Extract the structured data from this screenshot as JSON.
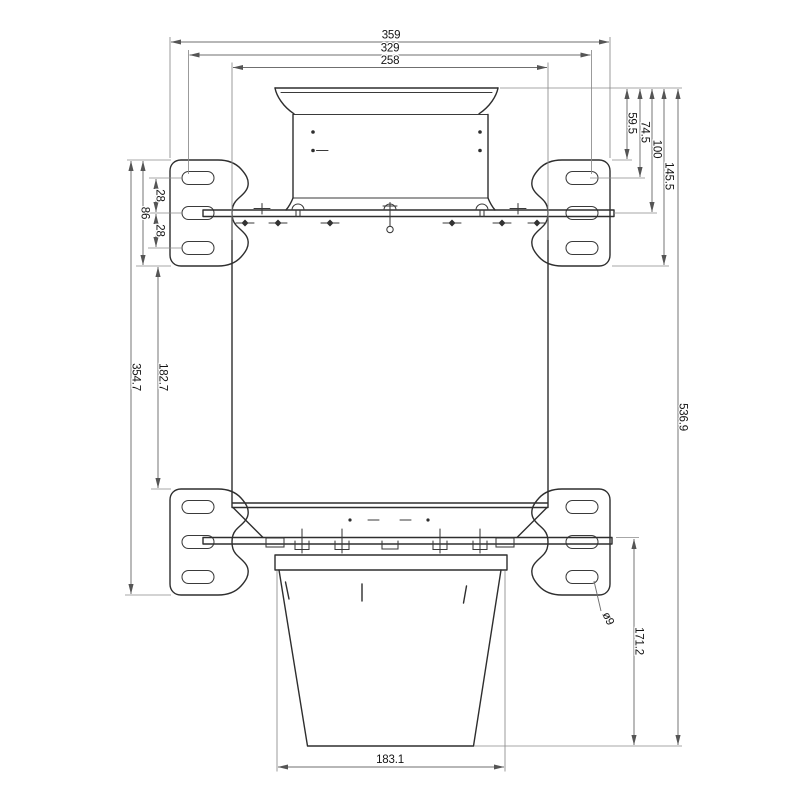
{
  "drawing": {
    "type": "engineering-dimension-drawing",
    "colors": {
      "background": "#ffffff",
      "part_line": "#2e2e2e",
      "dim_line": "#6f6f6f",
      "text": "#141414"
    },
    "dims": {
      "width_overall": "359",
      "width_slot_centers": "329",
      "width_body": "258",
      "slot_pitch_upper": "28",
      "bracket_height": "86",
      "slot_pitch_lower": "28",
      "bracket_span": "354.7",
      "bracket_gap": "182.7",
      "offset_bracket_top": "59.5",
      "offset_slot_top": "74.5",
      "offset_rail": "100",
      "offset_bracket_bottom": "145.5",
      "height_overall": "536.9",
      "bucket_height": "171.2",
      "bucket_width": "183.1",
      "hole_diameter": "ø9"
    }
  }
}
